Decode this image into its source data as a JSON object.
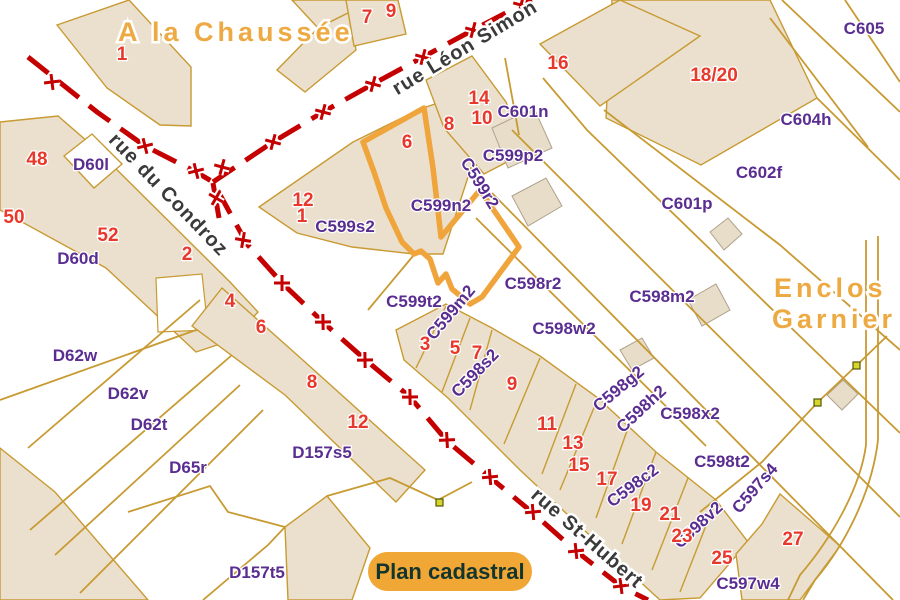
{
  "map": {
    "colors": {
      "highlight_orange": "#F0A43C",
      "road_red": "#C40000",
      "parcel_line_gold": "#C89A32",
      "building_fill": "#EAE0CD",
      "house_number_red": "#E8372B",
      "parcel_label_purple": "#5A2D91",
      "area_label_orange": "#EDAA42",
      "street_text": "#3A3A3A",
      "badge_fill": "#F0A735",
      "badge_text": "#14352E",
      "marker_yellow": "#D6D62A"
    },
    "badge": {
      "label": "Plan cadastral"
    },
    "street_labels": [
      {
        "text": "rue Léon Simon",
        "x": 468,
        "y": 53,
        "r": -31
      },
      {
        "text": "rue du Condroz",
        "x": 164,
        "y": 199,
        "r": 46
      },
      {
        "text": "rue St-Hubert",
        "x": 583,
        "y": 543,
        "r": 41
      }
    ],
    "area_labels": [
      {
        "text": "A la Chaussée",
        "x": 118,
        "y": 41,
        "r": 0
      },
      {
        "text": "Enclos",
        "x": 774,
        "y": 297,
        "r": 0
      },
      {
        "text": "Garnier",
        "x": 772,
        "y": 328,
        "r": 0
      }
    ],
    "parcel_labels": [
      {
        "text": "D60l",
        "x": 91,
        "y": 170,
        "r": 0
      },
      {
        "text": "D60d",
        "x": 78,
        "y": 264,
        "r": 0
      },
      {
        "text": "D62w",
        "x": 75,
        "y": 361,
        "r": 0
      },
      {
        "text": "D62v",
        "x": 128,
        "y": 399,
        "r": 0
      },
      {
        "text": "D62t",
        "x": 149,
        "y": 430,
        "r": 0
      },
      {
        "text": "D65r",
        "x": 188,
        "y": 473,
        "r": 0
      },
      {
        "text": "D157s5",
        "x": 322,
        "y": 458,
        "r": 0
      },
      {
        "text": "D157t5",
        "x": 257,
        "y": 578,
        "r": 0
      },
      {
        "text": "C599s2",
        "x": 345,
        "y": 232,
        "r": 0
      },
      {
        "text": "C599n2",
        "x": 441,
        "y": 211,
        "r": 0
      },
      {
        "text": "C599r2",
        "x": 475,
        "y": 186,
        "r": 58
      },
      {
        "text": "C599p2",
        "x": 513,
        "y": 161,
        "r": 0
      },
      {
        "text": "C601n",
        "x": 523,
        "y": 117,
        "r": 0
      },
      {
        "text": "C605",
        "x": 864,
        "y": 34,
        "r": 0
      },
      {
        "text": "C604h",
        "x": 806,
        "y": 125,
        "r": 0
      },
      {
        "text": "C602f",
        "x": 759,
        "y": 178,
        "r": 0
      },
      {
        "text": "C601p",
        "x": 687,
        "y": 209,
        "r": 0
      },
      {
        "text": "C598r2",
        "x": 533,
        "y": 289,
        "r": 0
      },
      {
        "text": "C598m2",
        "x": 662,
        "y": 302,
        "r": 0
      },
      {
        "text": "C598w2",
        "x": 564,
        "y": 334,
        "r": 0
      },
      {
        "text": "C599t2",
        "x": 414,
        "y": 307,
        "r": 0
      },
      {
        "text": "C599m2",
        "x": 455,
        "y": 316,
        "r": -50
      },
      {
        "text": "C598s2",
        "x": 479,
        "y": 377,
        "r": -46
      },
      {
        "text": "C598g2",
        "x": 622,
        "y": 393,
        "r": -40
      },
      {
        "text": "C598h2",
        "x": 645,
        "y": 413,
        "r": -43
      },
      {
        "text": "C598x2",
        "x": 690,
        "y": 419,
        "r": 0
      },
      {
        "text": "C598t2",
        "x": 722,
        "y": 467,
        "r": 0
      },
      {
        "text": "C598c2",
        "x": 636,
        "y": 490,
        "r": -37
      },
      {
        "text": "C598v2",
        "x": 702,
        "y": 529,
        "r": -43
      },
      {
        "text": "C597s4",
        "x": 759,
        "y": 492,
        "r": -49
      },
      {
        "text": "C597w4",
        "x": 748,
        "y": 589,
        "r": 0
      }
    ],
    "house_numbers": [
      {
        "text": "1",
        "x": 122,
        "y": 60
      },
      {
        "text": "7",
        "x": 367,
        "y": 23
      },
      {
        "text": "9",
        "x": 391,
        "y": 17
      },
      {
        "text": "16",
        "x": 558,
        "y": 69
      },
      {
        "text": "14",
        "x": 479,
        "y": 104
      },
      {
        "text": "10",
        "x": 482,
        "y": 124
      },
      {
        "text": "8",
        "x": 449,
        "y": 130
      },
      {
        "text": "18/20",
        "x": 714,
        "y": 81
      },
      {
        "text": "6",
        "x": 407,
        "y": 148
      },
      {
        "text": "12",
        "x": 303,
        "y": 206
      },
      {
        "text": "1",
        "x": 302,
        "y": 222
      },
      {
        "text": "48",
        "x": 37,
        "y": 165
      },
      {
        "text": "50",
        "x": 14,
        "y": 223
      },
      {
        "text": "52",
        "x": 108,
        "y": 241
      },
      {
        "text": "2",
        "x": 187,
        "y": 260
      },
      {
        "text": "4",
        "x": 230,
        "y": 307
      },
      {
        "text": "6",
        "x": 261,
        "y": 333
      },
      {
        "text": "8",
        "x": 312,
        "y": 388
      },
      {
        "text": "12",
        "x": 358,
        "y": 428
      },
      {
        "text": "3",
        "x": 425,
        "y": 350
      },
      {
        "text": "5",
        "x": 455,
        "y": 354
      },
      {
        "text": "7",
        "x": 477,
        "y": 359
      },
      {
        "text": "9",
        "x": 512,
        "y": 390
      },
      {
        "text": "11",
        "x": 547,
        "y": 430
      },
      {
        "text": "13",
        "x": 573,
        "y": 449
      },
      {
        "text": "15",
        "x": 579,
        "y": 471
      },
      {
        "text": "17",
        "x": 607,
        "y": 485
      },
      {
        "text": "19",
        "x": 641,
        "y": 511
      },
      {
        "text": "21",
        "x": 670,
        "y": 520
      },
      {
        "text": "23",
        "x": 682,
        "y": 542
      },
      {
        "text": "25",
        "x": 722,
        "y": 564
      },
      {
        "text": "27",
        "x": 793,
        "y": 545
      }
    ]
  }
}
